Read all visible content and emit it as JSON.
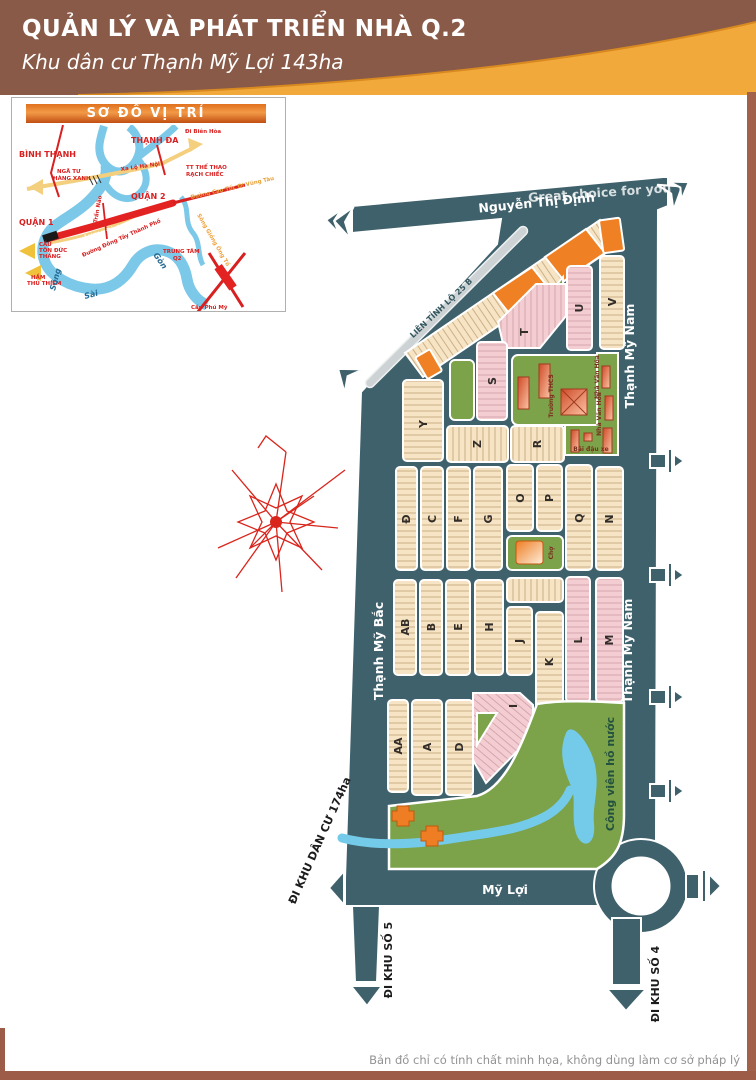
{
  "header": {
    "title": "QUẢN LÝ VÀ PHÁT TRIỂN NHÀ Q.2",
    "subtitle": "Khu dân cư Thạnh Mỹ Lợi 143ha"
  },
  "inset": {
    "title": "SƠ ĐỒ VỊ TRÍ",
    "districts": {
      "binh_thanh": "BÌNH THẠNH",
      "thanh_da": "THẠNH ĐA",
      "quan_2": "QUẬN 2",
      "quan_1": "QUẬN 1"
    },
    "places": {
      "nga_tu_1": "NGÃ TƯ",
      "nga_tu_2": "HÀNG XANH",
      "tt_1": "TT THỂ THAO",
      "tt_2": "RẠCH CHIẾC",
      "trung_tam_1": "TRUNG TÂM",
      "trung_tam_2": "Q2",
      "cau_tdt_1": "CẦU",
      "cau_tdt_2": "TÔN ĐỨC",
      "cau_tdt_3": "THẮNG",
      "ham_1": "HẦM",
      "ham_2": "THỦ THIÊM",
      "cau_phu_my": "Cầu Phú Mỹ"
    },
    "roads": {
      "xa_lo": "Xa Lộ Hà Nội",
      "di_bien_hoa": "Đi Biên Hòa",
      "cao_toc": "Đường Cao Tốc Đi Vũng Tàu",
      "luong_dinh_cua": "Lương Định Của",
      "dong_tay": "Đường Đông Tây Thành Phố",
      "tran_nao": "Trần Não"
    },
    "water": {
      "song": "Sông",
      "sai": "Sài",
      "gon": "Gòn",
      "giong_ong_to": "Sông Giồng Ông Tố"
    }
  },
  "map": {
    "roads": {
      "nguyen_thi_dinh": "Nguyễn Thị Định",
      "lien_tinh": "LIÊN TỈNH LỘ 25 B",
      "thanh_my_nam": "Thạnh Mỹ Nam",
      "thanh_my_bac": "Thạnh Mỹ Bắc",
      "my_loi": "Mỹ Lợi"
    },
    "exits": {
      "khu_dan_cu": "ĐI KHU DÂN CƯ 174ha",
      "khu_so_5": "ĐI KHU SỐ 5",
      "khu_so_4": "ĐI KHU SỐ 4"
    },
    "blocks": {
      "Y": "Y",
      "Z": "Z",
      "R": "R",
      "S": "S",
      "T": "T",
      "U": "U",
      "V": "V",
      "DD": "Đ",
      "C": "C",
      "F": "F",
      "G": "G",
      "O": "O",
      "P": "P",
      "Q": "Q",
      "N": "N",
      "AB": "AB",
      "B": "B",
      "E": "E",
      "H": "H",
      "J": "J",
      "K": "K",
      "L": "L",
      "M": "M",
      "AA": "AA",
      "A": "A",
      "D": "D",
      "I": "I"
    },
    "facilities": {
      "school": "Trường THCS",
      "culture_house": "Nhà Văn Hóa",
      "parking": "Bãi đậu xe",
      "market": "Chợ",
      "park": "Công viên hồ nước"
    },
    "watermark": "Great choice for you"
  },
  "footer": {
    "disclaimer": "Bản đồ chỉ có tính chất minh họa, không dùng làm cơ sở pháp lý"
  },
  "colors": {
    "road_teal": "#3f616c",
    "block_beige": "#f6e4c4",
    "block_pink": "#f3cdd2",
    "highlight_orange": "#f08024",
    "green_area": "#7ca24a",
    "water_blue": "#74cbe9",
    "header_brown": "#8a5a49",
    "header_yellow": "#f2a93b"
  }
}
